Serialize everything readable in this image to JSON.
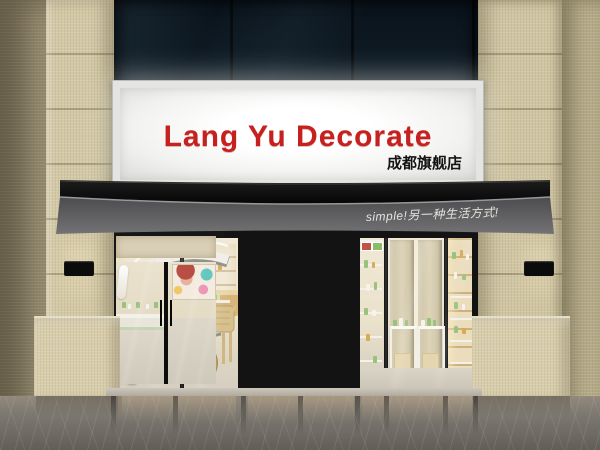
{
  "scene": {
    "store_name": "Lang Yu Decorate",
    "branch_label": "成都旗舰店",
    "awning_slogan": "simple!另一种生活方式!"
  },
  "signboard": {
    "title": "Lang Yu Decorate",
    "title_color": "#c6201f",
    "subtitle": "成都旗舰店",
    "subtitle_color": "#141414",
    "panel_color": "#f7f7f5"
  },
  "awning": {
    "slogan": "simple!另一种生活方式!",
    "slogan_color": "#e4e4e0",
    "canopy_color": "#0d0d0d",
    "skirt_color": "#59595b"
  },
  "facade": {
    "tile_color": "#d3c9a7",
    "upper_glass_color": "#0e1a24",
    "frame_color": "#141414",
    "interior_color": "#eee4cd",
    "street_floor_color": "#7a766f"
  }
}
